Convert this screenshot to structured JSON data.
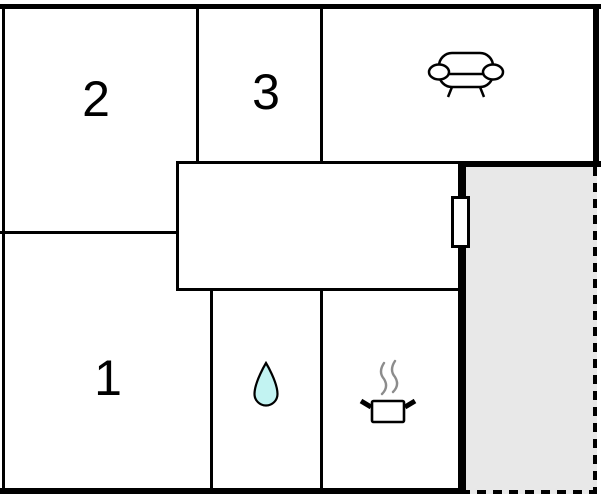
{
  "floorplan": {
    "type": "apartment-floor-plan",
    "rooms": {
      "room1": {
        "label": "1"
      },
      "room2": {
        "label": "2"
      },
      "room3": {
        "label": "3"
      },
      "living_room": {
        "icon": "sofa-icon"
      },
      "bathroom": {
        "icon": "water-drop-icon"
      },
      "kitchen": {
        "icon": "cooking-pot-icon"
      },
      "hallway": {
        "icon": ""
      },
      "terrace": {
        "icon": ""
      }
    },
    "colors": {
      "wall": "#000000",
      "room_fill": "#ffffff",
      "terrace_fill": "#e8e8e8",
      "water_drop_fill": "#c2f3f2",
      "steam": "#8c8c8c"
    }
  }
}
